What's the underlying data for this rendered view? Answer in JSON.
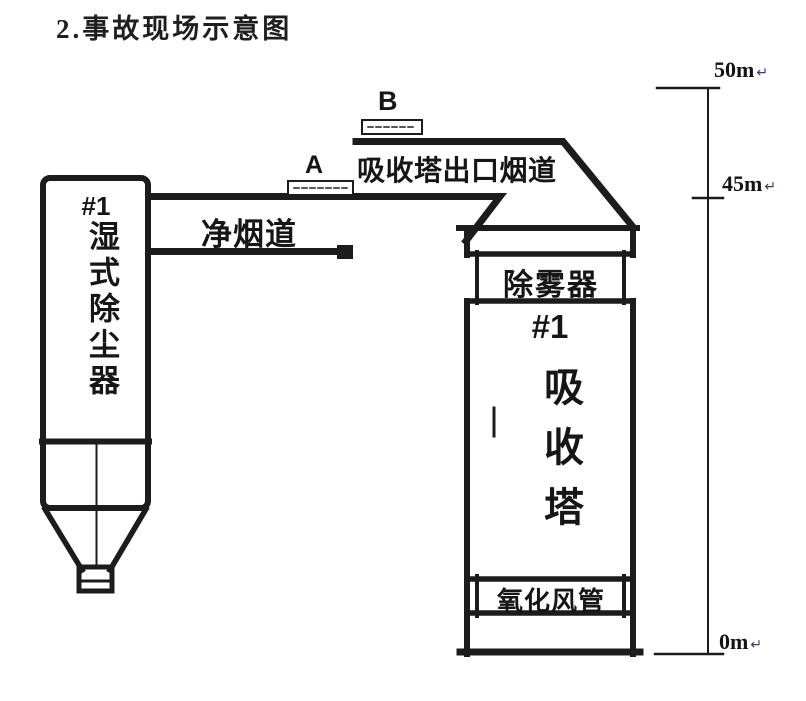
{
  "title": "2.事故现场示意图",
  "diagram": {
    "point_a": "A",
    "point_b": "B",
    "clean_flue_label": "净烟道",
    "outlet_flue_label": "吸收塔出口烟道",
    "left_tower": {
      "unit": "#1",
      "name": "湿式除尘器"
    },
    "right_tower": {
      "unit": "#1",
      "name": "吸收塔",
      "demister": "除雾器",
      "oxidation_duct": "氧化风管"
    },
    "scale": {
      "label_50m": "50m",
      "label_45m": "45m",
      "label_0m": "0m",
      "paragraph_mark": "↵"
    },
    "colors": {
      "line": "#1c1c1c",
      "background": "#ffffff",
      "paragraph_mark": "#3c3c5e"
    }
  }
}
